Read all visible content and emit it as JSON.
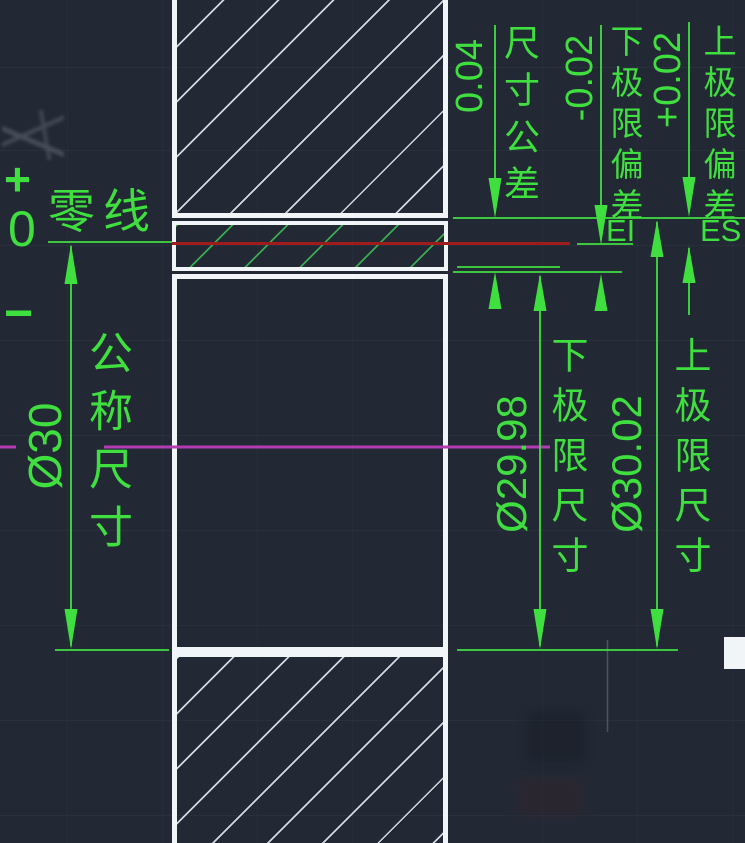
{
  "labels": {
    "zero_line": "零线",
    "plus": "+",
    "zero": "0",
    "minus": "−",
    "nominal_value": "Ø30",
    "nominal_name": "公称尺寸",
    "tolerance_value": "0.04",
    "tolerance_name": "尺寸公差",
    "lower_dev_value": "-0.02",
    "lower_dev_name": "下极限偏差",
    "lower_dev_symbol": "EI",
    "upper_dev_value": "+0.02",
    "upper_dev_name": "上极限偏差",
    "upper_dev_symbol": "ES",
    "lower_limit_value": "Ø29.98",
    "lower_limit_name": "下极限尺寸",
    "upper_limit_value": "Ø30.02",
    "upper_limit_name": "上极限尺寸"
  },
  "colors": {
    "bg": "#222935",
    "green": "#3fdf3f",
    "hatchgreen": "#2fa644",
    "red": "#a01b1b",
    "magenta": "#b23cb2",
    "white": "#f2f5f8"
  }
}
